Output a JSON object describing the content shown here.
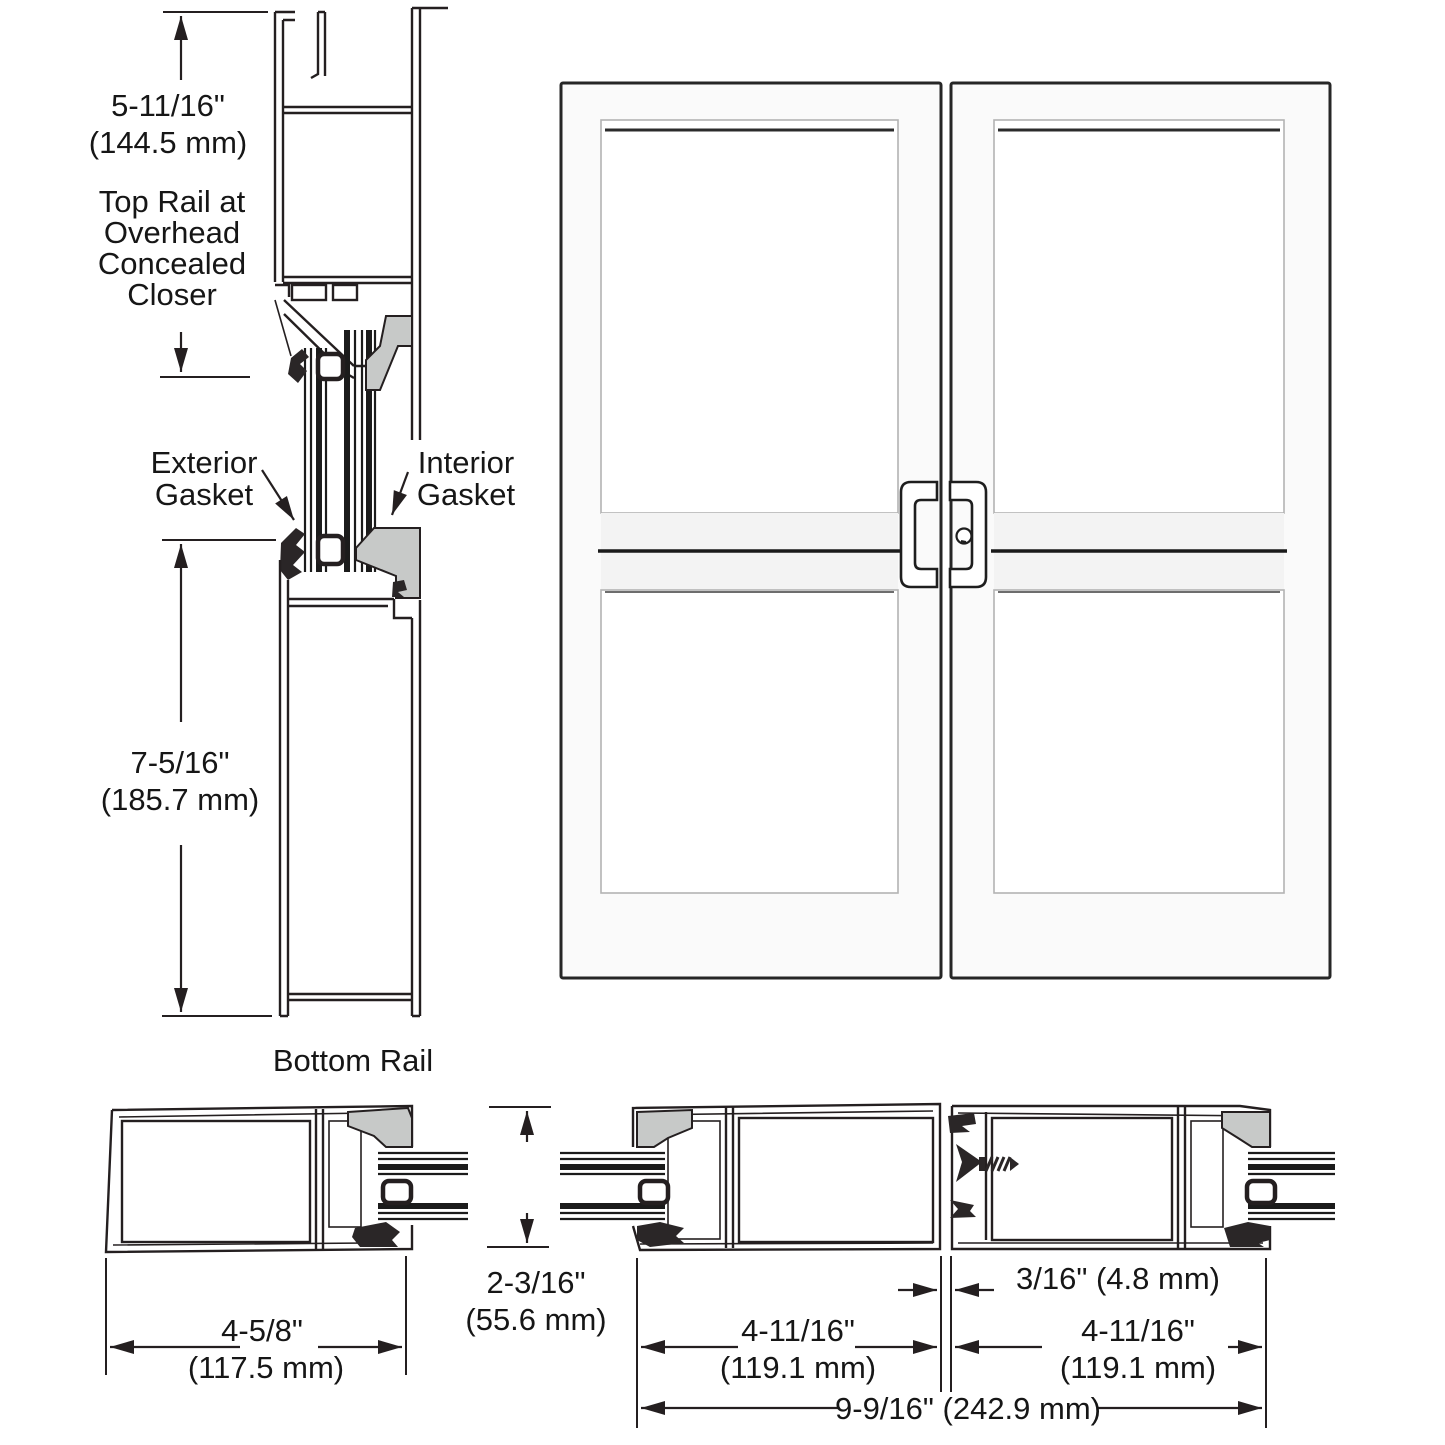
{
  "drawing": {
    "section_top": {
      "dim_in": "5-11/16\"",
      "dim_mm": "(144.5 mm)",
      "label_l1": "Top Rail at",
      "label_l2": "Overhead",
      "label_l3": "Concealed",
      "label_l4": "Closer"
    },
    "gasket_labels": {
      "exterior_l1": "Exterior",
      "exterior_l2": "Gasket",
      "interior_l1": "Interior",
      "interior_l2": "Gasket"
    },
    "section_bottom": {
      "dim_in": "7-5/16\"",
      "dim_mm": "(185.7 mm)",
      "label": "Bottom Rail"
    },
    "plan_hinge_stile": {
      "dim_in": "4-5/8\"",
      "dim_mm": "(117.5 mm)"
    },
    "plan_door_thickness": {
      "dim_in": "2-3/16\"",
      "dim_mm": "(55.6 mm)"
    },
    "plan_meeting_stiles": {
      "left_dim_in": "4-11/16\"",
      "left_dim_mm": "(119.1 mm)",
      "gap_dim": "3/16\" (4.8 mm)",
      "right_dim_in": "4-11/16\"",
      "right_dim_mm": "(119.1 mm)",
      "overall_dim": "9-9/16\" (242.9 mm)"
    },
    "colors": {
      "line": "#241f20",
      "gasket_gray": "#c7c9c8",
      "door_face": "#fafafa",
      "background": "#ffffff"
    }
  }
}
